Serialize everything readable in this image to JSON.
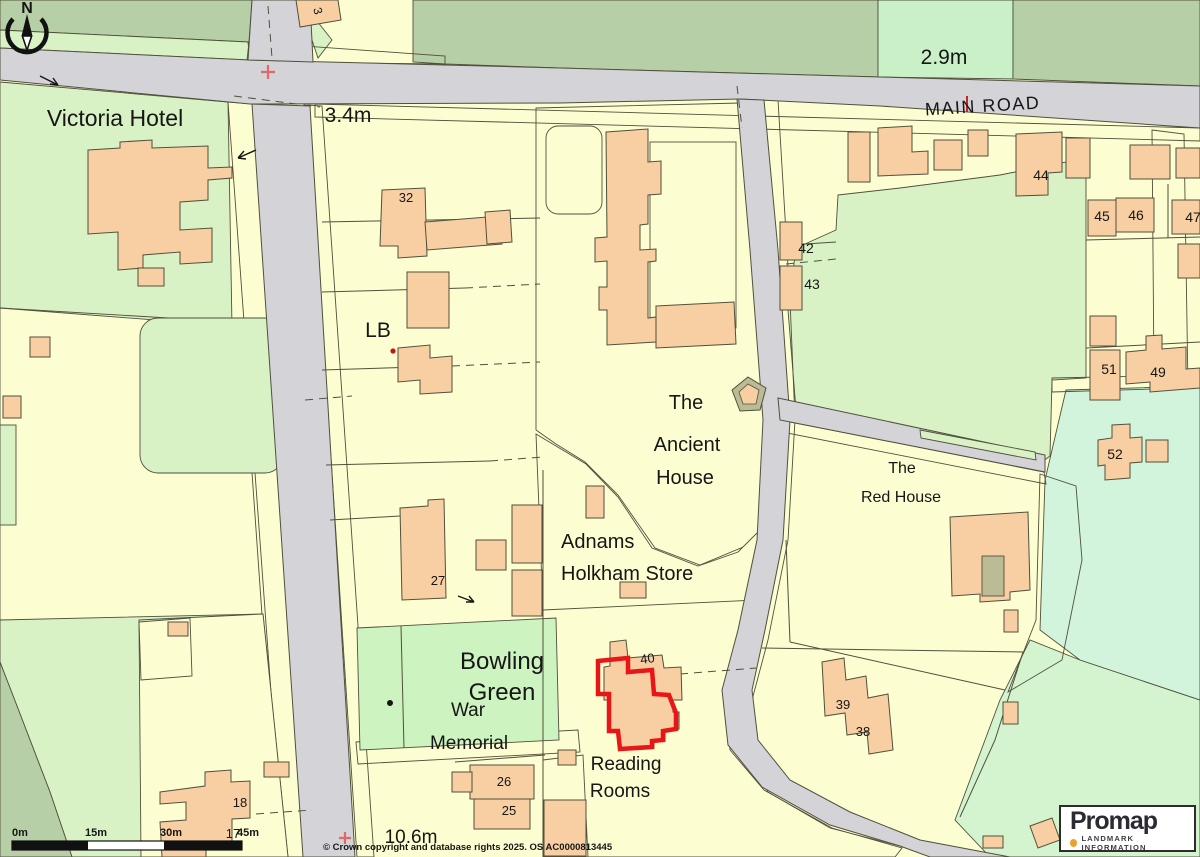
{
  "palette": {
    "road": "#d3d3d8",
    "verge": "#bababf00",
    "outline": "#50503c",
    "plot": "#fdfdd2",
    "building": "#f8cfa2",
    "green_light": "#d9f2c5",
    "green_mint": "#c9f0c6",
    "green_sage": "#b7cfa7",
    "green_bowling": "#cdf3c0",
    "green_bottom": "#d4f4d0",
    "green_cyan": "#d2f3dc",
    "red": "#e81616",
    "red_soft": "#e06868",
    "accent_orange": "#f0a030",
    "verge_fill": "#bbbb95"
  },
  "compass": {
    "north": "N"
  },
  "labels": [
    {
      "text": "Victoria Hotel",
      "x": 115,
      "y": 126,
      "size": 23
    },
    {
      "text": "3.4m",
      "x": 348,
      "y": 122,
      "size": 21
    },
    {
      "text": "2.9m",
      "x": 944,
      "y": 64,
      "size": 21
    },
    {
      "text": "MAIN ROAD",
      "x": 983,
      "y": 112,
      "size": 18,
      "spacing": 1.5,
      "rotate": -3.5
    },
    {
      "text": "3",
      "x": 314,
      "y": 12,
      "size": 12,
      "rotate": 75
    },
    {
      "text": "32",
      "x": 406,
      "y": 202,
      "size": 13
    },
    {
      "text": "LB",
      "x": 378,
      "y": 337,
      "size": 21
    },
    {
      "text": "42",
      "x": 806,
      "y": 253,
      "size": 14
    },
    {
      "text": "43",
      "x": 812,
      "y": 289,
      "size": 14
    },
    {
      "text": "44",
      "x": 1041,
      "y": 180,
      "size": 14
    },
    {
      "text": "45",
      "x": 1102,
      "y": 221,
      "size": 14
    },
    {
      "text": "46",
      "x": 1136,
      "y": 220,
      "size": 14
    },
    {
      "text": "47",
      "x": 1193,
      "y": 222,
      "size": 14
    },
    {
      "text": "51",
      "x": 1109,
      "y": 374,
      "size": 14
    },
    {
      "text": "49",
      "x": 1158,
      "y": 377,
      "size": 14
    },
    {
      "text": "52",
      "x": 1115,
      "y": 459,
      "size": 14
    },
    {
      "text": "The",
      "x": 686,
      "y": 409,
      "size": 20
    },
    {
      "text": "Ancient",
      "x": 687,
      "y": 451,
      "size": 20
    },
    {
      "text": "House",
      "x": 685,
      "y": 484,
      "size": 20
    },
    {
      "text": "The",
      "x": 902,
      "y": 473,
      "size": 16
    },
    {
      "text": "Red House",
      "x": 901,
      "y": 502,
      "size": 16
    },
    {
      "text": "Adnams",
      "x": 561,
      "y": 548,
      "size": 20,
      "anchor": "start"
    },
    {
      "text": "Holkham Store",
      "x": 561,
      "y": 580,
      "size": 20,
      "anchor": "start"
    },
    {
      "text": "Bowling",
      "x": 502,
      "y": 669,
      "size": 24
    },
    {
      "text": "Green",
      "x": 502,
      "y": 700,
      "size": 24
    },
    {
      "text": "War",
      "x": 468,
      "y": 716,
      "size": 19
    },
    {
      "text": "Memorial",
      "x": 469,
      "y": 749,
      "size": 19
    },
    {
      "text": "Reading",
      "x": 626,
      "y": 770,
      "size": 19
    },
    {
      "text": "Rooms",
      "x": 620,
      "y": 797,
      "size": 19
    },
    {
      "text": "27",
      "x": 438,
      "y": 585,
      "size": 13
    },
    {
      "text": "40",
      "x": 648,
      "y": 663,
      "size": 13,
      "rotate": -8
    },
    {
      "text": "39",
      "x": 843,
      "y": 709,
      "size": 13
    },
    {
      "text": "38",
      "x": 863,
      "y": 736,
      "size": 13
    },
    {
      "text": "26",
      "x": 504,
      "y": 786,
      "size": 13
    },
    {
      "text": "25",
      "x": 509,
      "y": 815,
      "size": 13
    },
    {
      "text": "18",
      "x": 240,
      "y": 807,
      "size": 13
    },
    {
      "text": "17",
      "x": 233,
      "y": 838,
      "size": 13
    },
    {
      "text": "10.6m",
      "x": 411,
      "y": 843,
      "size": 19
    }
  ],
  "scalebar": {
    "labels": [
      {
        "text": "0m",
        "x": 12
      },
      {
        "text": "15m",
        "x": 85
      },
      {
        "text": "30m",
        "x": 160
      },
      {
        "text": "45m",
        "x": 237
      }
    ]
  },
  "notices": {
    "copyright": "© Crown copyright and database rights 2025. OS AC0000813445"
  },
  "promap": {
    "name": "Promap",
    "tagline": "LANDMARK INFORMATION"
  }
}
